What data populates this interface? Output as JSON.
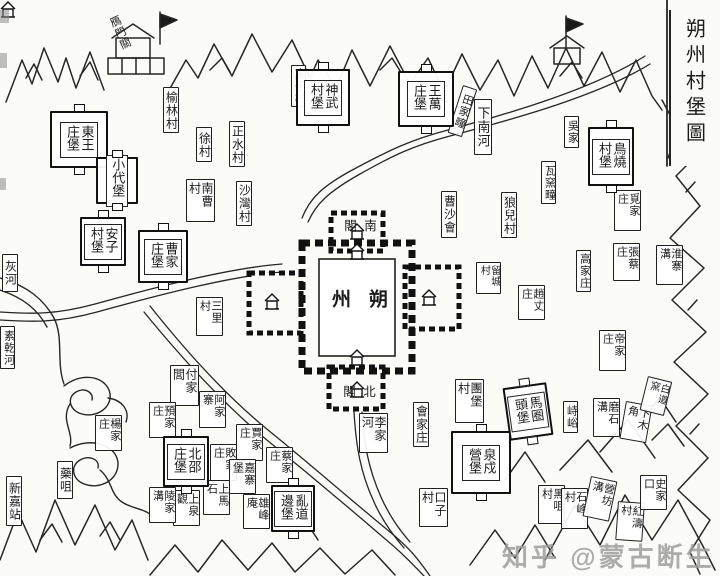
{
  "title": "朔州村堡圖",
  "watermark": "知乎 @蒙古断生",
  "city": {
    "name": "朔州",
    "gate_top": "南閣",
    "gate_bottom": "北閣"
  },
  "villages": [
    {
      "label": "鴈門關",
      "x": 104,
      "y": 16,
      "h": 44,
      "fs": 11,
      "rot": -24,
      "box": false
    },
    {
      "label": "榆林村",
      "x": 163,
      "y": 87,
      "h": 46,
      "fs": 12
    },
    {
      "label": "窯子村",
      "x": 291,
      "y": 65,
      "h": 42,
      "fs": 11
    },
    {
      "label": "下南河",
      "x": 474,
      "y": 99,
      "h": 56,
      "fs": 13
    },
    {
      "label": "徐村",
      "x": 196,
      "y": 127,
      "h": 35,
      "fs": 12
    },
    {
      "label": "正水村",
      "x": 229,
      "y": 121,
      "h": 46,
      "fs": 12
    },
    {
      "label": "沙灣村",
      "x": 236,
      "y": 181,
      "h": 45,
      "fs": 12
    },
    {
      "label": "南曹村",
      "x": 186,
      "y": 179,
      "h": 43,
      "fs": 12
    },
    {
      "label": "三里村",
      "x": 196,
      "y": 297,
      "h": 39,
      "fs": 11
    },
    {
      "label": "田家疃",
      "x": 463,
      "y": 85,
      "h": 50,
      "fs": 11,
      "rot": 18
    },
    {
      "label": "瓦窯疃",
      "x": 541,
      "y": 161,
      "h": 43,
      "fs": 11
    },
    {
      "label": "吳家",
      "x": 564,
      "y": 116,
      "h": 32,
      "fs": 11
    },
    {
      "label": "曹沙會",
      "x": 441,
      "y": 191,
      "h": 47,
      "fs": 12
    },
    {
      "label": "狼兒村",
      "x": 501,
      "y": 192,
      "h": 46,
      "fs": 12
    },
    {
      "label": "覓家庄",
      "x": 614,
      "y": 190,
      "h": 41,
      "fs": 11
    },
    {
      "label": "淮寨溝",
      "x": 656,
      "y": 245,
      "h": 40,
      "fs": 11
    },
    {
      "label": "張蔡庄",
      "x": 613,
      "y": 243,
      "h": 38,
      "fs": 11
    },
    {
      "label": "高家庄",
      "x": 576,
      "y": 250,
      "h": 42,
      "fs": 11
    },
    {
      "label": "留城村",
      "x": 476,
      "y": 262,
      "h": 32,
      "fs": 10
    },
    {
      "label": "趙丈庄",
      "x": 518,
      "y": 285,
      "h": 35,
      "fs": 11
    },
    {
      "label": "帝家庄",
      "x": 599,
      "y": 330,
      "h": 41,
      "fs": 11
    },
    {
      "label": "峙峪",
      "x": 563,
      "y": 401,
      "h": 32,
      "fs": 11
    },
    {
      "label": "磨石溝",
      "x": 593,
      "y": 398,
      "h": 39,
      "fs": 11
    },
    {
      "label": "下木角",
      "x": 626,
      "y": 401,
      "h": 38,
      "fs": 11,
      "rot": 10
    },
    {
      "label": "白道窯",
      "x": 648,
      "y": 376,
      "h": 35,
      "fs": 10,
      "rot": 14
    },
    {
      "label": "團堡村",
      "x": 455,
      "y": 379,
      "h": 44,
      "fs": 12
    },
    {
      "label": "會家庄",
      "x": 413,
      "y": 402,
      "h": 45,
      "fs": 12
    },
    {
      "label": "李家河",
      "x": 359,
      "y": 413,
      "h": 40,
      "fs": 12
    },
    {
      "label": "口子村",
      "x": 419,
      "y": 488,
      "h": 39,
      "fs": 12
    },
    {
      "label": "付家閭",
      "x": 170,
      "y": 365,
      "h": 41,
      "fs": 12
    },
    {
      "label": "阿家寨",
      "x": 199,
      "y": 391,
      "h": 37,
      "fs": 11
    },
    {
      "label": "預家庄",
      "x": 149,
      "y": 402,
      "h": 36,
      "fs": 11
    },
    {
      "label": "賈家庄",
      "x": 236,
      "y": 424,
      "h": 37,
      "fs": 11
    },
    {
      "label": "敗家庄",
      "x": 210,
      "y": 444,
      "h": 37,
      "fs": 11
    },
    {
      "label": "嘉寨堡",
      "x": 229,
      "y": 459,
      "h": 35,
      "fs": 11
    },
    {
      "label": "蔡家庄",
      "x": 266,
      "y": 447,
      "h": 36,
      "fs": 11
    },
    {
      "label": "上馬石",
      "x": 203,
      "y": 480,
      "h": 35,
      "fs": 11
    },
    {
      "label": "上泉觀",
      "x": 173,
      "y": 490,
      "h": 36,
      "fs": 11
    },
    {
      "label": "陵家溝",
      "x": 149,
      "y": 487,
      "h": 36,
      "fs": 11
    },
    {
      "label": "雄峰庵",
      "x": 243,
      "y": 494,
      "h": 35,
      "fs": 11
    },
    {
      "label": "楊家庄",
      "x": 95,
      "y": 415,
      "h": 36,
      "fs": 11
    },
    {
      "label": "藥咀",
      "x": 57,
      "y": 461,
      "h": 38,
      "fs": 12
    },
    {
      "label": "新嘉站",
      "x": 6,
      "y": 476,
      "h": 50,
      "fs": 12
    },
    {
      "label": "黑咀村",
      "x": 538,
      "y": 485,
      "h": 39,
      "fs": 11
    },
    {
      "label": "石峰村",
      "x": 561,
      "y": 488,
      "h": 41,
      "fs": 11
    },
    {
      "label": "營坊溝",
      "x": 591,
      "y": 476,
      "h": 41,
      "fs": 11,
      "rot": 12
    },
    {
      "label": "紅濤村",
      "x": 618,
      "y": 501,
      "h": 39,
      "fs": 11,
      "rot": 4
    },
    {
      "label": "史家口",
      "x": 640,
      "y": 475,
      "h": 35,
      "fs": 11
    },
    {
      "label": "灰河",
      "x": 2,
      "y": 254,
      "h": 38,
      "fs": 12
    },
    {
      "label": "素乾河",
      "x": 0,
      "y": 326,
      "h": 43,
      "fs": 11
    }
  ],
  "forts": [
    {
      "label": "東王庄堡",
      "x": 50,
      "y": 111,
      "w": 58,
      "h": 57
    },
    {
      "label": "小代堡",
      "x": 96,
      "y": 157,
      "w": 42,
      "h": 47,
      "cols": 1
    },
    {
      "label": "神武村堡",
      "x": 296,
      "y": 69,
      "w": 54,
      "h": 57
    },
    {
      "label": "王萬庄堡",
      "x": 398,
      "y": 71,
      "w": 56,
      "h": 56
    },
    {
      "label": "安子村堡",
      "x": 80,
      "y": 217,
      "w": 46,
      "h": 49
    },
    {
      "label": "曹家庄堡",
      "x": 138,
      "y": 230,
      "w": 50,
      "h": 53
    },
    {
      "label": "北邵庄堡",
      "x": 163,
      "y": 436,
      "w": 46,
      "h": 51
    },
    {
      "label": "泉戍營堡",
      "x": 451,
      "y": 431,
      "w": 60,
      "h": 63
    },
    {
      "label": "亂道邊堡",
      "x": 271,
      "y": 485,
      "w": 44,
      "h": 47
    },
    {
      "label": "鳥燒村堡",
      "x": 588,
      "y": 127,
      "w": 46,
      "h": 59
    },
    {
      "label": "馬圈頭堡",
      "x": 506,
      "y": 385,
      "w": 44,
      "h": 53,
      "rot": -8
    }
  ],
  "ink_color": "#222222",
  "paper_color": "#fbfbf8"
}
